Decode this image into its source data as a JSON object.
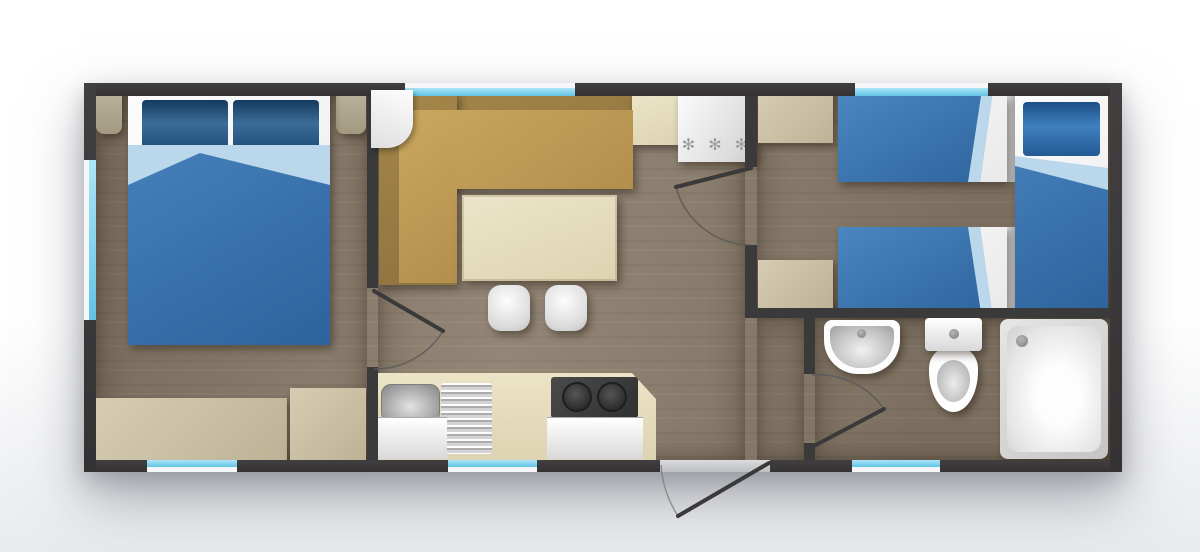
{
  "plan": {
    "title": "mobile-home-floor-plan",
    "canvas": {
      "width": 1200,
      "height": 552
    },
    "freezer": {
      "stars": "✻ ✻ ✻"
    },
    "counts": {
      "windows": 6,
      "interior_doors": 3,
      "entrance_doors": 1
    },
    "colors": {
      "wall": "#3a3a3a",
      "floor_wood": "#8b7d6c",
      "window_glass": "#7fd0ee",
      "bed_duvet": "#3a72ad",
      "bed_fold": "#bad7ec",
      "pillow": "#1c4a74",
      "sofa_frame": "#a5874a",
      "sofa_seat": "#c2a059",
      "counter_cream": "#e8e0c3",
      "cabinet_beige": "#c9c0a5",
      "fixture_white": "#ffffff",
      "stove_dark": "#3d3d3d"
    },
    "rooms": [
      {
        "id": "bedroom-double",
        "furniture": [
          "double-bed",
          "pillow",
          "pillow",
          "nightstand",
          "nightstand",
          "sideboard",
          "cabinet"
        ]
      },
      {
        "id": "living-kitchen",
        "furniture": [
          "corner-sofa",
          "dining-table",
          "stool",
          "stool",
          "kitchen-counter",
          "sink",
          "draining-board",
          "stove",
          "fridge-freezer",
          "wall-cabinet"
        ]
      },
      {
        "id": "bedroom-twin",
        "furniture": [
          "single-bed",
          "single-bed",
          "single-bed",
          "cabinet",
          "cabinet"
        ]
      },
      {
        "id": "bathroom",
        "furniture": [
          "wash-basin",
          "toilet",
          "shower-tray"
        ]
      }
    ]
  }
}
